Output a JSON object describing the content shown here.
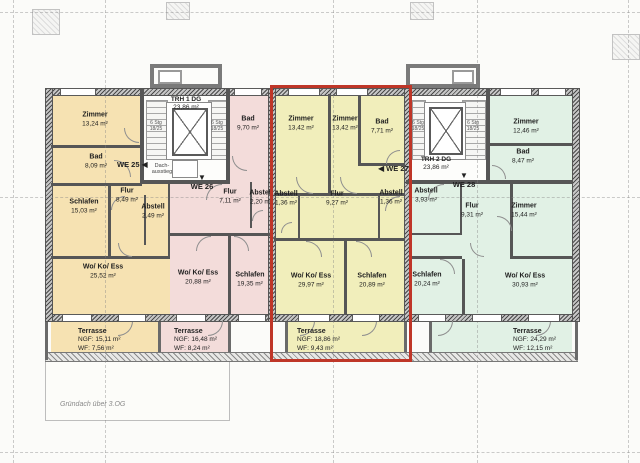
{
  "plan_note": "Gründach über 3.OG",
  "colors": {
    "we25_fill": "#f6e2b2",
    "we26_fill": "#f3dcda",
    "we27_fill": "#f1eebb",
    "we28_fill": "#e1f1e5",
    "highlight_border": "#bf3628",
    "wall": "#565656"
  },
  "stairwells": {
    "trh1": {
      "name": "TRH 1 DG",
      "area": "23,86 m²",
      "roof_access": "Dach-ausstieg",
      "stair_text_top": "6 Stg",
      "stair_text_bottom": "18/25"
    },
    "trh2": {
      "name": "TRH 2 DG",
      "area": "23,86 m²",
      "stair_text_top": "6 Stg",
      "stair_text_bottom": "18/25"
    }
  },
  "apartments": {
    "we25": {
      "id": "WE 25",
      "arrow": "◀",
      "rooms": [
        {
          "label": "Zimmer",
          "area": "13,24 m²"
        },
        {
          "label": "Bad",
          "area": "8,09 m²"
        },
        {
          "label": "Schlafen",
          "area": "15,03 m²"
        },
        {
          "label": "Flur",
          "area": "8,49 m²"
        },
        {
          "label": "Abstell",
          "area": "2,49 m²"
        },
        {
          "label": "Wo/ Ko/ Ess",
          "area": "25,52 m²"
        }
      ],
      "terrace": {
        "label": "Terrasse",
        "ngf": "NGF: 15,11 m²",
        "wf": "WF: 7,56 m²"
      }
    },
    "we26": {
      "id": "WE 26",
      "arrow": "▼",
      "rooms": [
        {
          "label": "Bad",
          "area": "9,70 m²"
        },
        {
          "label": "Flur",
          "area": "7,11 m²"
        },
        {
          "label": "Abstell",
          "area": "2,20 m²"
        },
        {
          "label": "Wo/ Ko/ Ess",
          "area": "20,88 m²"
        },
        {
          "label": "Schlafen",
          "area": "19,35 m²"
        }
      ],
      "terrace": {
        "label": "Terrasse",
        "ngf": "NGF: 16,48 m²",
        "wf": "WF: 8,24 m²"
      }
    },
    "we27": {
      "id": "WE 27",
      "arrow": "◀",
      "highlighted": true,
      "rooms": [
        {
          "label": "Zimmer",
          "area": "13,42 m²"
        },
        {
          "label": "Zimmer",
          "area": "13,42 m²"
        },
        {
          "label": "Bad",
          "area": "7,71 m²"
        },
        {
          "label": "Abstell",
          "area": "1,36 m²"
        },
        {
          "label": "Flur",
          "area": "9,27 m²"
        },
        {
          "label": "Abstell",
          "area": "1,36 m²"
        },
        {
          "label": "Wo/ Ko/ Ess",
          "area": "29,97 m²"
        },
        {
          "label": "Schlafen",
          "area": "20,89 m²"
        }
      ],
      "terrace": {
        "label": "Terrasse",
        "ngf": "NGF: 18,86 m²",
        "wf": "WF: 9,43 m²"
      }
    },
    "we28": {
      "id": "WE 28",
      "arrow": "▼",
      "rooms": [
        {
          "label": "Zimmer",
          "area": "12,46 m²"
        },
        {
          "label": "Bad",
          "area": "8,47 m²"
        },
        {
          "label": "Abstell",
          "area": "3,93 m²"
        },
        {
          "label": "Flur",
          "area": "9,31 m²"
        },
        {
          "label": "Zimmer",
          "area": "15,44 m²"
        },
        {
          "label": "Schlafen",
          "area": "20,24 m²"
        },
        {
          "label": "Wo/ Ko/ Ess",
          "area": "30,93 m²"
        }
      ],
      "terrace": {
        "label": "Terrasse",
        "ngf": "NGF: 24,29 m²",
        "wf": "WF: 12,15 m²"
      }
    }
  }
}
